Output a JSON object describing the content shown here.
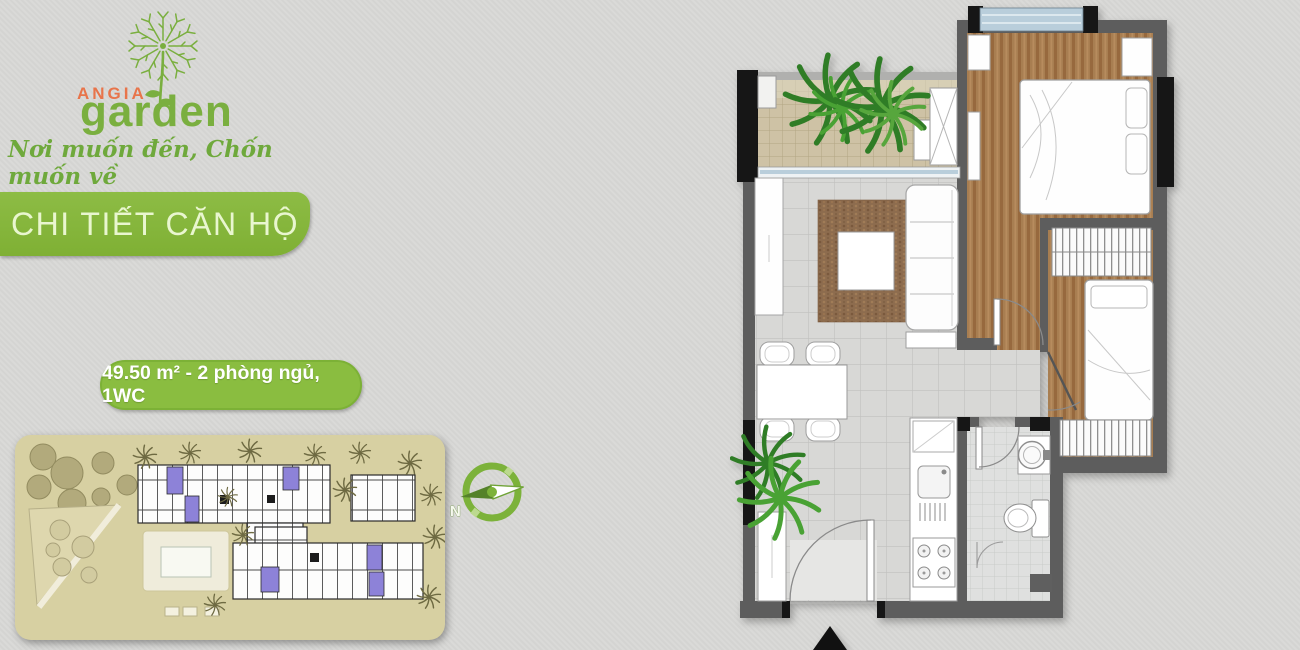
{
  "brand": {
    "name_line1": "ANGIA",
    "name_line2": "garden",
    "tagline": "Nơi muốn đến, Chốn muốn về",
    "colors": {
      "brand_green": "#7aaf3f",
      "brand_orange": "#e8744a",
      "banner_green": "#85b53c",
      "banner_text": "#e9f6cf"
    }
  },
  "heading": {
    "title": "CHI TIẾT CĂN HỘ"
  },
  "unit_info": {
    "summary": "49.50 m² - 2 phòng ngủ, 1WC"
  },
  "compass": {
    "north_label": "N"
  },
  "icons": {
    "logo": "dandelion-icon",
    "compass": "compass-north-icon",
    "entry_marker": "north-triangle-icon"
  },
  "palette": {
    "background": "#d8d8d6",
    "wall": "#5d5d5d",
    "post_black": "#161616",
    "wood_floor": "#a87e51",
    "tile_floor": "#d8d8d6",
    "balcony_floor": "#cec2a5",
    "window_glass": "#b9cedb",
    "rug_brown": "#8d6c4e",
    "plant_green": "#2f7d26",
    "siteplan_ground": "#d7d0a2",
    "siteplan_highlight_unit": "#8d82d8"
  }
}
